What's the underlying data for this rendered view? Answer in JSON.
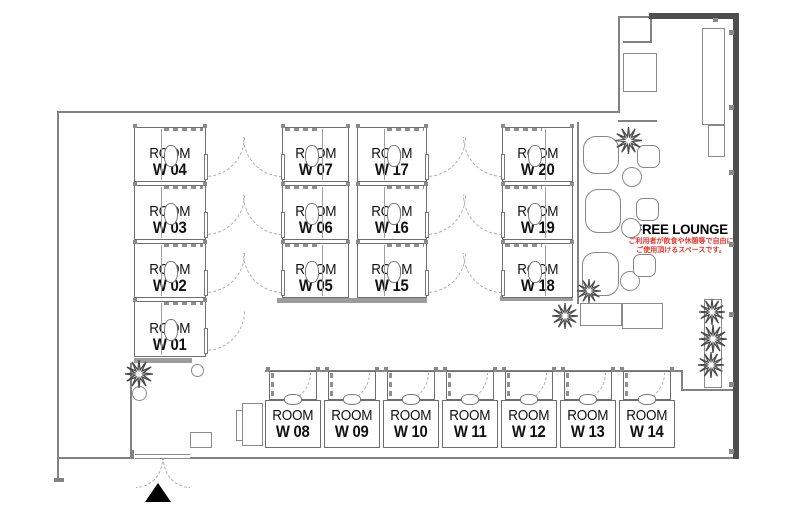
{
  "labels": {
    "room_word": "ROOM"
  },
  "lounge": {
    "title": "FREE LOUNGE",
    "note_line1": "ご利用者が飲食や休憩等で自由に",
    "note_line2": "ご使用頂けるスペースです。",
    "note_color": "#e8362b"
  },
  "icons": {
    "plant": "plant-icon",
    "entrance_marker": "triangle-up-icon"
  },
  "floorplan": {
    "rooms": [
      {
        "id": "W 04",
        "x": 134,
        "y": 127,
        "w": 72,
        "h": 55,
        "door": "right"
      },
      {
        "id": "W 03",
        "x": 134,
        "y": 185,
        "w": 72,
        "h": 55,
        "door": "right"
      },
      {
        "id": "W 02",
        "x": 134,
        "y": 243,
        "w": 72,
        "h": 55,
        "door": "right"
      },
      {
        "id": "W 01",
        "x": 134,
        "y": 301,
        "w": 72,
        "h": 56,
        "door": "right"
      },
      {
        "id": "W 07",
        "x": 282,
        "y": 127,
        "w": 67,
        "h": 55,
        "door": "left"
      },
      {
        "id": "W 06",
        "x": 282,
        "y": 185,
        "w": 67,
        "h": 55,
        "door": "left"
      },
      {
        "id": "W 05",
        "x": 282,
        "y": 243,
        "w": 67,
        "h": 55,
        "door": "left"
      },
      {
        "id": "W 17",
        "x": 357,
        "y": 127,
        "w": 70,
        "h": 55,
        "door": "right"
      },
      {
        "id": "W 16",
        "x": 357,
        "y": 185,
        "w": 70,
        "h": 55,
        "door": "right"
      },
      {
        "id": "W 15",
        "x": 357,
        "y": 243,
        "w": 70,
        "h": 55,
        "door": "right"
      },
      {
        "id": "W 20",
        "x": 502,
        "y": 127,
        "w": 71,
        "h": 55,
        "door": "left"
      },
      {
        "id": "W 19",
        "x": 502,
        "y": 185,
        "w": 71,
        "h": 55,
        "door": "left"
      },
      {
        "id": "W 18",
        "x": 502,
        "y": 243,
        "w": 71,
        "h": 55,
        "door": "left"
      },
      {
        "id": "W 08",
        "x": 265,
        "y": 371,
        "w": 56,
        "h": 77,
        "door": "top"
      },
      {
        "id": "W 09",
        "x": 324,
        "y": 371,
        "w": 56,
        "h": 77,
        "door": "top"
      },
      {
        "id": "W 10",
        "x": 383,
        "y": 371,
        "w": 56,
        "h": 77,
        "door": "top"
      },
      {
        "id": "W 11",
        "x": 442,
        "y": 371,
        "w": 56,
        "h": 77,
        "door": "top"
      },
      {
        "id": "W 12",
        "x": 501,
        "y": 371,
        "w": 56,
        "h": 77,
        "door": "top"
      },
      {
        "id": "W 13",
        "x": 560,
        "y": 371,
        "w": 56,
        "h": 77,
        "door": "top"
      },
      {
        "id": "W 14",
        "x": 619,
        "y": 371,
        "w": 56,
        "h": 77,
        "door": "top"
      }
    ],
    "walls": [
      {
        "x": 57,
        "y": 111,
        "w": 563,
        "h": 2,
        "t": "thin",
        "n": "top-wall"
      },
      {
        "x": 57,
        "y": 111,
        "w": 2,
        "h": 369,
        "t": "thin",
        "n": "left-wall"
      },
      {
        "x": 54,
        "y": 478,
        "w": 10,
        "h": 4,
        "t": "thin",
        "n": "wall-cap"
      },
      {
        "x": 57,
        "y": 457,
        "w": 77,
        "h": 2,
        "t": "thin",
        "n": "bottom-wall"
      },
      {
        "x": 132,
        "y": 450,
        "w": 2,
        "h": 9,
        "t": "thin",
        "n": "entrance-jamb"
      },
      {
        "x": 190,
        "y": 457,
        "w": 548,
        "h": 2,
        "t": "thin",
        "n": "bottom-wall"
      },
      {
        "x": 130,
        "y": 363,
        "w": 2,
        "h": 96,
        "t": "thin",
        "n": "vestibule-wall"
      },
      {
        "x": 618,
        "y": 16,
        "w": 2,
        "h": 96,
        "t": "thin",
        "n": "lobby-wall"
      },
      {
        "x": 618,
        "y": 16,
        "w": 34,
        "h": 2,
        "t": "thin",
        "n": "lobby-wall"
      },
      {
        "x": 650,
        "y": 16,
        "w": 2,
        "h": 27,
        "t": "thin",
        "n": "lobby-wall"
      },
      {
        "x": 623,
        "y": 41,
        "w": 29,
        "h": 2,
        "t": "thin",
        "n": "lobby-wall"
      },
      {
        "x": 618,
        "y": 120,
        "w": 39,
        "h": 2,
        "t": "thin",
        "n": "lounge-top-wall"
      },
      {
        "x": 577,
        "y": 122,
        "w": 2,
        "h": 182,
        "t": "thin",
        "n": "lounge-left-wall"
      },
      {
        "x": 675,
        "y": 370,
        "w": 8,
        "h": 2,
        "t": "thin",
        "n": "step-wall"
      },
      {
        "x": 681,
        "y": 370,
        "w": 2,
        "h": 21,
        "t": "thin",
        "n": "step-wall"
      },
      {
        "x": 681,
        "y": 389,
        "w": 53,
        "h": 2,
        "t": "thin",
        "n": "step-wall"
      },
      {
        "x": 265,
        "y": 370,
        "w": 410,
        "h": 1.5,
        "t": "thin",
        "n": "room-row-line"
      },
      {
        "x": 649,
        "y": 13,
        "w": 90,
        "h": 6,
        "t": "thick",
        "n": "exterior-wall"
      },
      {
        "x": 733,
        "y": 13,
        "w": 6,
        "h": 446,
        "t": "thick",
        "n": "exterior-wall"
      },
      {
        "x": 134,
        "y": 358,
        "w": 58,
        "h": 5,
        "t": "bar",
        "n": "room-block-base"
      },
      {
        "x": 277,
        "y": 298,
        "w": 150,
        "h": 5,
        "t": "bar",
        "n": "room-block-base"
      },
      {
        "x": 500,
        "y": 296,
        "w": 73,
        "h": 5,
        "t": "bar",
        "n": "room-block-base"
      }
    ],
    "posts": [
      [
        729,
        30
      ],
      [
        729,
        105
      ],
      [
        729,
        170
      ],
      [
        729,
        242
      ],
      [
        729,
        312
      ],
      [
        729,
        382
      ],
      [
        729,
        449
      ],
      [
        713,
        18,
        5,
        4
      ]
    ],
    "rects": [
      {
        "x": 623,
        "y": 53,
        "w": 34,
        "h": 39,
        "n": "cabinet"
      },
      {
        "x": 702,
        "y": 28,
        "w": 23,
        "h": 97,
        "n": "counter"
      },
      {
        "x": 708,
        "y": 125,
        "w": 17,
        "h": 32,
        "n": "counter"
      },
      {
        "x": 580,
        "y": 303,
        "w": 42,
        "h": 23,
        "n": "lounge-table"
      },
      {
        "x": 622,
        "y": 303,
        "w": 41,
        "h": 26,
        "n": "lounge-table"
      },
      {
        "x": 242,
        "y": 403,
        "w": 21,
        "h": 43,
        "n": "locker"
      },
      {
        "x": 236,
        "y": 410,
        "w": 7,
        "h": 31,
        "n": "locker-side"
      },
      {
        "x": 190,
        "y": 432,
        "w": 22,
        "h": 16,
        "n": "entrance-cabinet"
      },
      {
        "x": 704,
        "y": 299,
        "w": 18,
        "h": 89,
        "n": "planter"
      }
    ],
    "circles": [
      {
        "x": 622,
        "y": 167,
        "d": 20,
        "n": "lounge-round-table"
      },
      {
        "x": 621,
        "y": 218,
        "d": 20,
        "n": "lounge-round-table"
      },
      {
        "x": 620,
        "y": 271,
        "d": 20,
        "n": "lounge-round-table"
      },
      {
        "x": 132,
        "y": 386,
        "d": 15,
        "n": "plant-pot"
      },
      {
        "x": 191,
        "y": 364,
        "d": 13,
        "n": "plant-pot"
      }
    ],
    "sofas": [
      {
        "x": 583,
        "y": 136,
        "w": 36,
        "h": 38
      },
      {
        "x": 585,
        "y": 189,
        "w": 36,
        "h": 44
      },
      {
        "x": 582,
        "y": 252,
        "w": 37,
        "h": 44
      }
    ],
    "seats": [
      {
        "x": 637,
        "y": 145
      },
      {
        "x": 636,
        "y": 198
      },
      {
        "x": 633,
        "y": 254
      }
    ],
    "plants": [
      {
        "x": 139,
        "y": 374,
        "s": 28
      },
      {
        "x": 565,
        "y": 316,
        "s": 26
      },
      {
        "x": 589,
        "y": 291,
        "s": 24
      },
      {
        "x": 628,
        "y": 140,
        "s": 27
      },
      {
        "x": 712,
        "y": 312,
        "s": 26
      },
      {
        "x": 713,
        "y": 339,
        "s": 28
      },
      {
        "x": 711,
        "y": 365,
        "s": 26
      }
    ],
    "entrance": {
      "door_x": 135,
      "door_y": 454,
      "door_w": 55
    }
  }
}
